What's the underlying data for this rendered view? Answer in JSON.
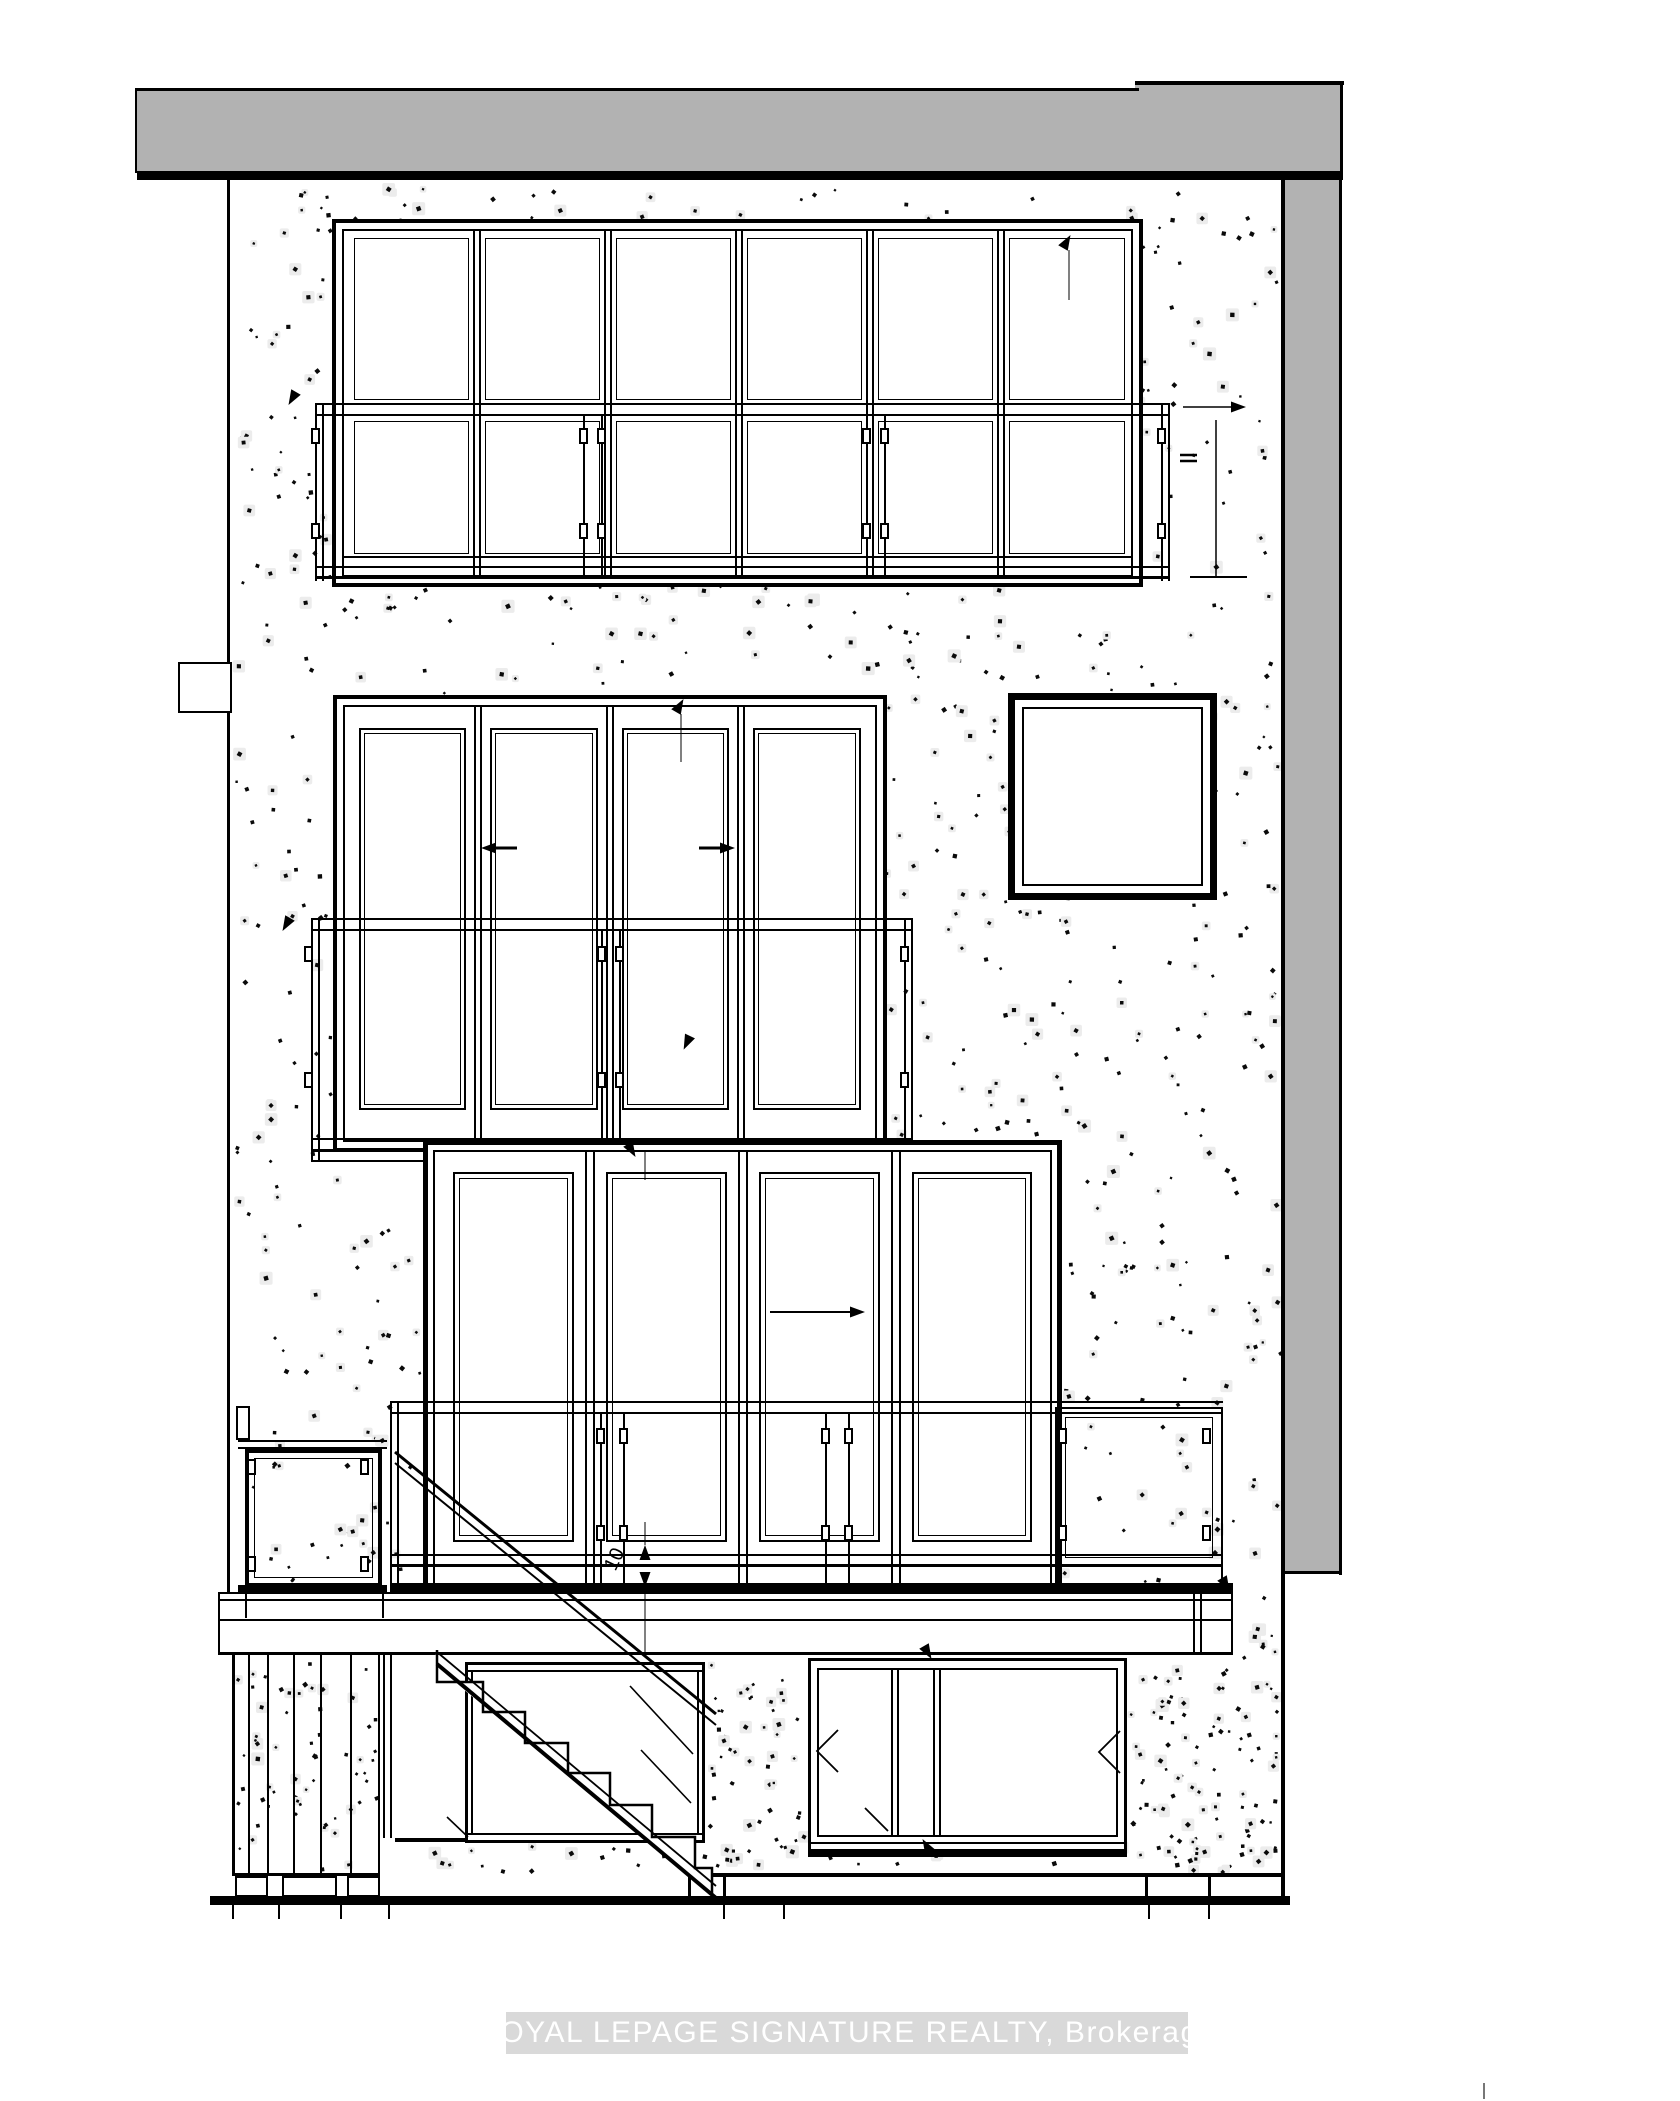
{
  "drawing": {
    "kind": "rear-elevation-architectural-drawing",
    "floors": [
      "basement",
      "main-floor",
      "third-floor",
      "second-floor"
    ],
    "features": [
      "roof-band",
      "stippled-wall",
      "second-floor-window",
      "third-floor-window",
      "upper-right-square-window",
      "main-floor-bifold-door",
      "balcony-railings",
      "left-gate",
      "right-railing-panel",
      "deck",
      "exterior-stairs",
      "basement-window-left",
      "basement-window-right",
      "ground-line"
    ]
  },
  "watermark": {
    "text": "ROYAL LEPAGE SIGNATURE REALTY, Brokerage"
  },
  "annotations": {
    "riser_dimension_label": "10"
  },
  "colors": {
    "line": "#000000",
    "roof_fill": "#b2b2b2",
    "wall_fill": "#ffffff",
    "stipple_dot": "#0a0a0a",
    "stipple_halo": "#ececec",
    "watermark_band": "#d9d9d9",
    "watermark_text": "#ffffff"
  }
}
